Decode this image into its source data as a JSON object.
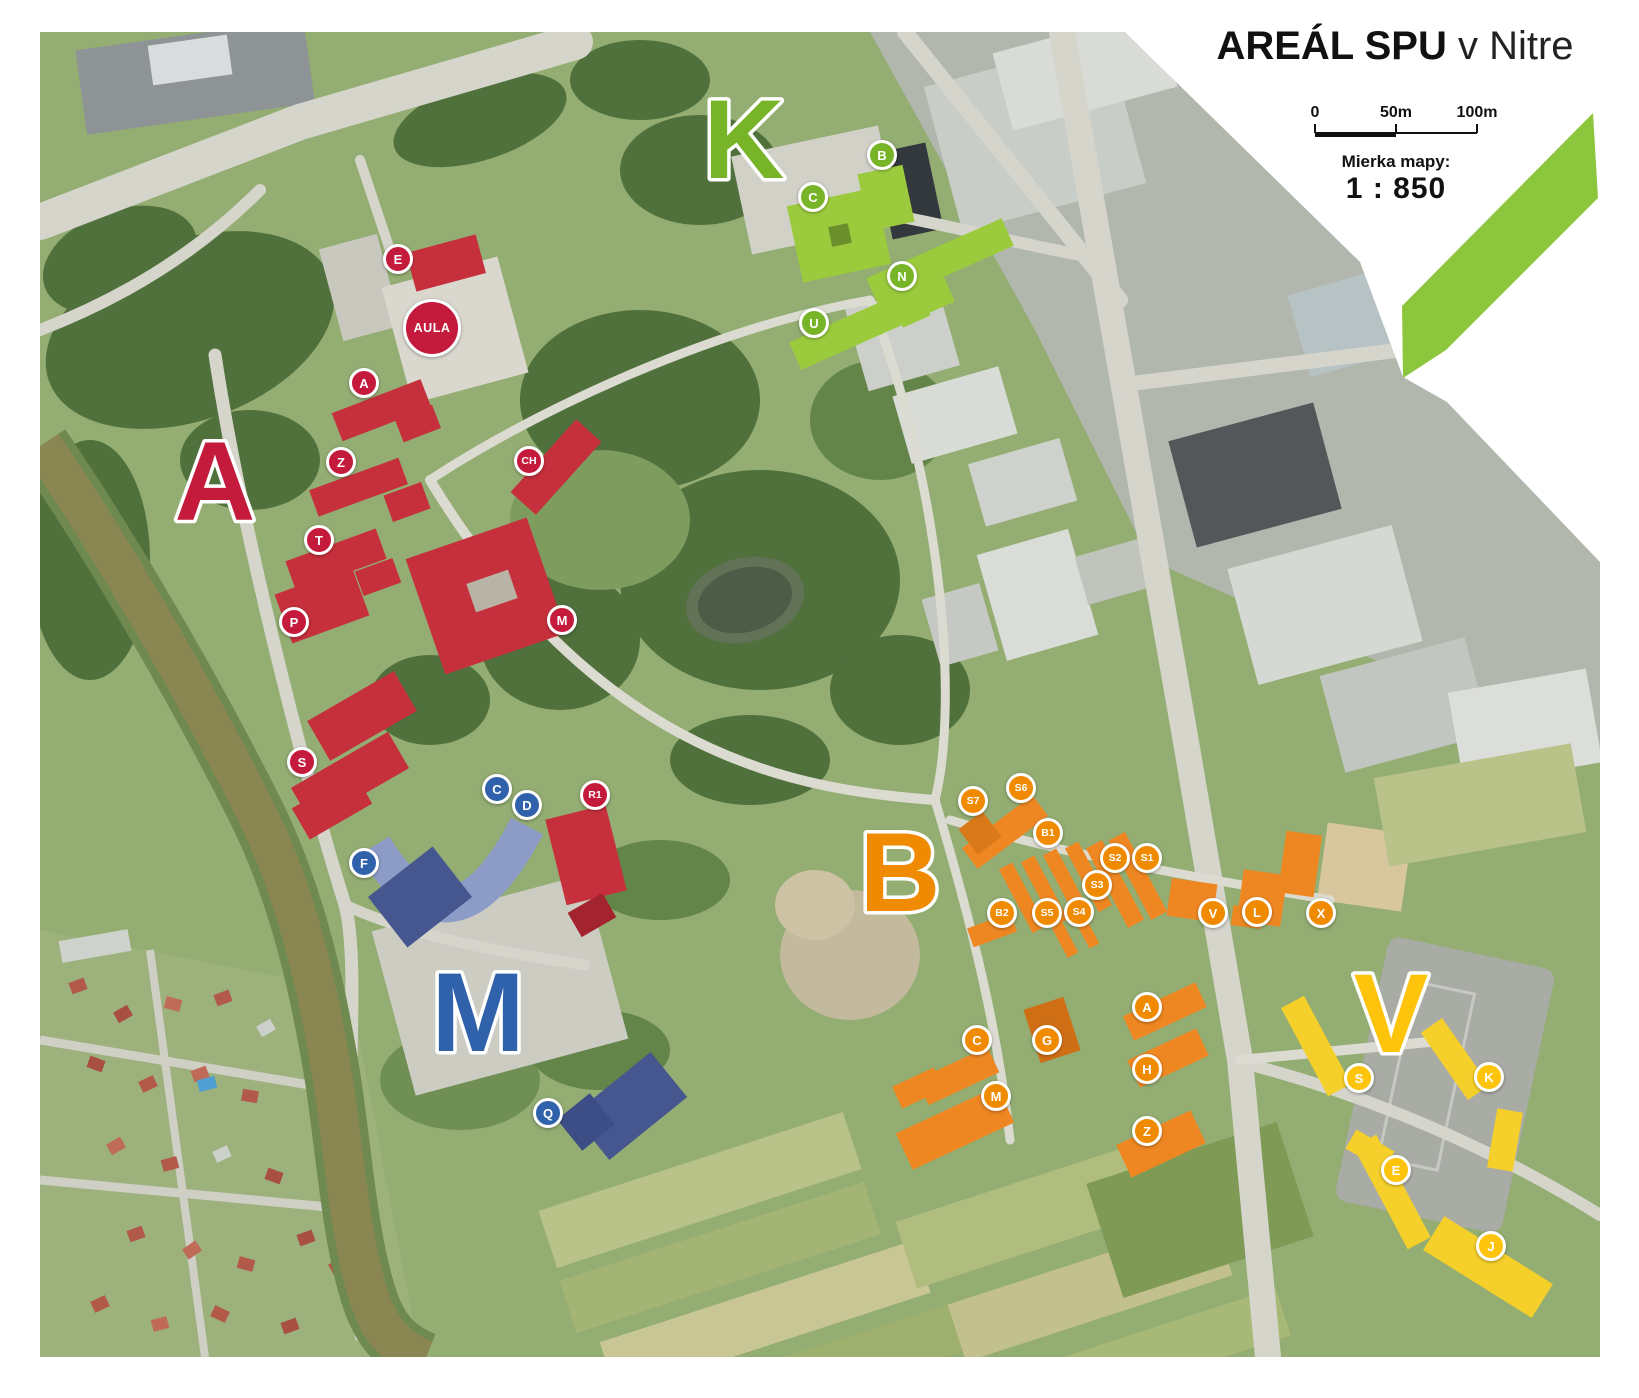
{
  "header": {
    "title_bold": "AREÁL SPU",
    "title_rest": " v Nitre"
  },
  "scale": {
    "labels": [
      "0",
      "50m",
      "100m"
    ],
    "caption": "Mierka mapy:",
    "ratio": "1 : 850"
  },
  "colors": {
    "red": "#c41a3b",
    "blue": "#2f62ab",
    "green": "#77b427",
    "orange": "#f08a00",
    "yellow": "#fdc40b",
    "ribbon": "#8cc63c"
  },
  "sections": [
    {
      "letter": "A",
      "group": "red",
      "x": 215,
      "y": 480
    },
    {
      "letter": "K",
      "group": "green",
      "x": 744,
      "y": 138
    },
    {
      "letter": "B",
      "group": "orange",
      "x": 900,
      "y": 871
    },
    {
      "letter": "M",
      "group": "blue",
      "x": 478,
      "y": 1011
    },
    {
      "letter": "V",
      "group": "yellow",
      "x": 1391,
      "y": 1012
    }
  ],
  "markers": [
    {
      "label": "E",
      "group": "red",
      "x": 398,
      "y": 259
    },
    {
      "label": "AULA",
      "group": "red",
      "x": 432,
      "y": 328,
      "big": true
    },
    {
      "label": "A",
      "group": "red",
      "x": 364,
      "y": 383
    },
    {
      "label": "Z",
      "group": "red",
      "x": 341,
      "y": 462
    },
    {
      "label": "CH",
      "group": "red",
      "x": 529,
      "y": 461
    },
    {
      "label": "T",
      "group": "red",
      "x": 319,
      "y": 540
    },
    {
      "label": "P",
      "group": "red",
      "x": 294,
      "y": 622
    },
    {
      "label": "M",
      "group": "red",
      "x": 562,
      "y": 620
    },
    {
      "label": "S",
      "group": "red",
      "x": 302,
      "y": 762
    },
    {
      "label": "R1",
      "group": "red",
      "x": 595,
      "y": 795
    },
    {
      "label": "C",
      "group": "blue",
      "x": 497,
      "y": 789
    },
    {
      "label": "D",
      "group": "blue",
      "x": 527,
      "y": 805
    },
    {
      "label": "F",
      "group": "blue",
      "x": 364,
      "y": 863
    },
    {
      "label": "Q",
      "group": "blue",
      "x": 548,
      "y": 1113
    },
    {
      "label": "B",
      "group": "green",
      "x": 882,
      "y": 155
    },
    {
      "label": "C",
      "group": "green",
      "x": 813,
      "y": 197
    },
    {
      "label": "N",
      "group": "green",
      "x": 902,
      "y": 276
    },
    {
      "label": "U",
      "group": "green",
      "x": 814,
      "y": 323
    },
    {
      "label": "S7",
      "group": "orange",
      "x": 973,
      "y": 801
    },
    {
      "label": "S6",
      "group": "orange",
      "x": 1021,
      "y": 788
    },
    {
      "label": "B1",
      "group": "orange",
      "x": 1048,
      "y": 833
    },
    {
      "label": "S2",
      "group": "orange",
      "x": 1115,
      "y": 858
    },
    {
      "label": "S1",
      "group": "orange",
      "x": 1147,
      "y": 858
    },
    {
      "label": "S3",
      "group": "orange",
      "x": 1097,
      "y": 885
    },
    {
      "label": "B2",
      "group": "orange",
      "x": 1002,
      "y": 913
    },
    {
      "label": "S5",
      "group": "orange",
      "x": 1047,
      "y": 913
    },
    {
      "label": "S4",
      "group": "orange",
      "x": 1079,
      "y": 912
    },
    {
      "label": "V",
      "group": "orange",
      "x": 1213,
      "y": 913
    },
    {
      "label": "L",
      "group": "orange",
      "x": 1257,
      "y": 912
    },
    {
      "label": "X",
      "group": "orange",
      "x": 1321,
      "y": 913
    },
    {
      "label": "A",
      "group": "orange",
      "x": 1147,
      "y": 1007
    },
    {
      "label": "C",
      "group": "orange",
      "x": 977,
      "y": 1040
    },
    {
      "label": "G",
      "group": "orange",
      "x": 1047,
      "y": 1040
    },
    {
      "label": "H",
      "group": "orange",
      "x": 1147,
      "y": 1069
    },
    {
      "label": "M",
      "group": "orange",
      "x": 996,
      "y": 1096
    },
    {
      "label": "Z",
      "group": "orange",
      "x": 1147,
      "y": 1131
    },
    {
      "label": "S",
      "group": "yellow",
      "x": 1359,
      "y": 1078
    },
    {
      "label": "K",
      "group": "yellow",
      "x": 1489,
      "y": 1077
    },
    {
      "label": "E",
      "group": "yellow",
      "x": 1396,
      "y": 1170
    },
    {
      "label": "J",
      "group": "yellow",
      "x": 1491,
      "y": 1246
    }
  ]
}
